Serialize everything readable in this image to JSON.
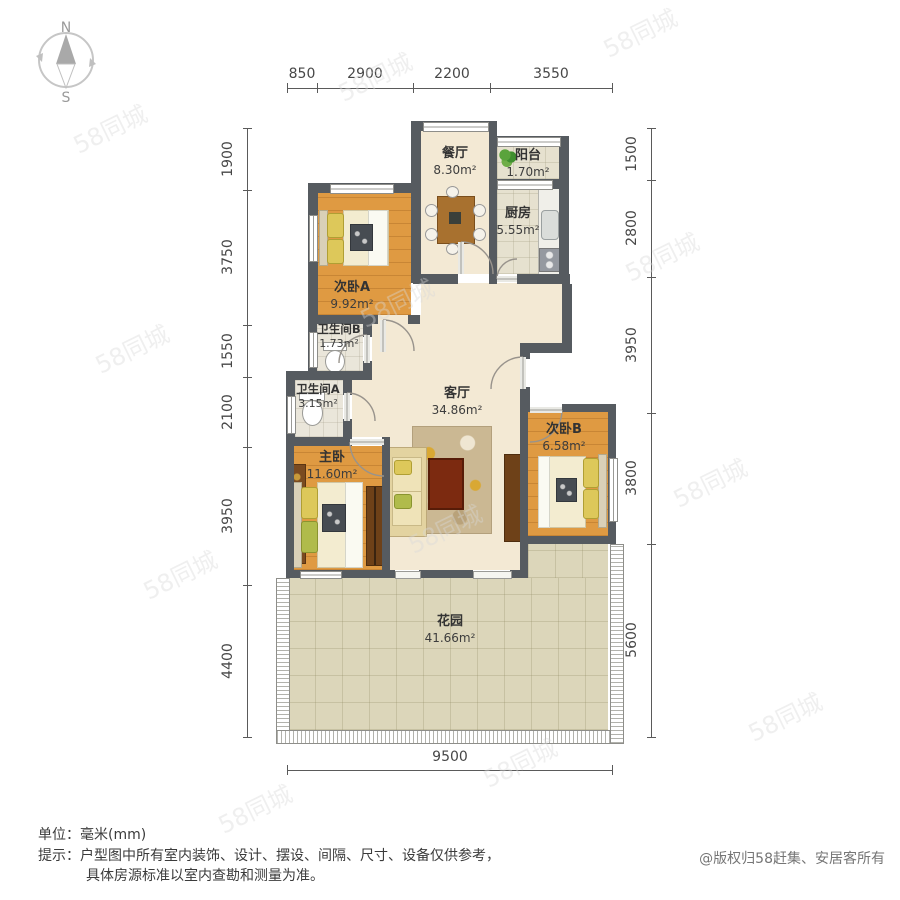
{
  "compass": {
    "north": "N",
    "south": "S"
  },
  "dimensions": {
    "top": [
      "850",
      "2900",
      "2200",
      "3550"
    ],
    "left": [
      "1900",
      "3750",
      "1550",
      "2100",
      "3950",
      "4400"
    ],
    "right": [
      "1500",
      "2800",
      "3950",
      "3800",
      "5600"
    ],
    "bottom": [
      "9500"
    ]
  },
  "rooms": [
    {
      "name": "餐厅",
      "area": "8.30m²"
    },
    {
      "name": "阳台",
      "area": "1.70m²"
    },
    {
      "name": "厨房",
      "area": "5.55m²"
    },
    {
      "name": "次卧A",
      "area": "9.92m²"
    },
    {
      "name": "卫生间B",
      "area": "1.73m²"
    },
    {
      "name": "卫生间A",
      "area": "3.15m²"
    },
    {
      "name": "主卧",
      "area": "11.60m²"
    },
    {
      "name": "客厅",
      "area": "34.86m²"
    },
    {
      "name": "次卧B",
      "area": "6.58m²"
    },
    {
      "name": "花园",
      "area": "41.66m²"
    }
  ],
  "footer": {
    "unit": "单位：毫米(mm)",
    "tip1": "提示：户型图中所有室内装饰、设计、摆设、间隔、尺寸、设备仅供参考，",
    "tip2": "具体房源标准以室内查勘和测量为准。",
    "copyright": "@版权归58赶集、安居客所有"
  },
  "watermark": {
    "text": "58同城"
  },
  "colors": {
    "wall": "#565b60",
    "wood_floor": "#df9a42",
    "cream_floor": "#f3e9d4",
    "garden_tile": "#dcd6ba",
    "coffee_table": "#7c2a10",
    "dimension_text": "#474747"
  }
}
